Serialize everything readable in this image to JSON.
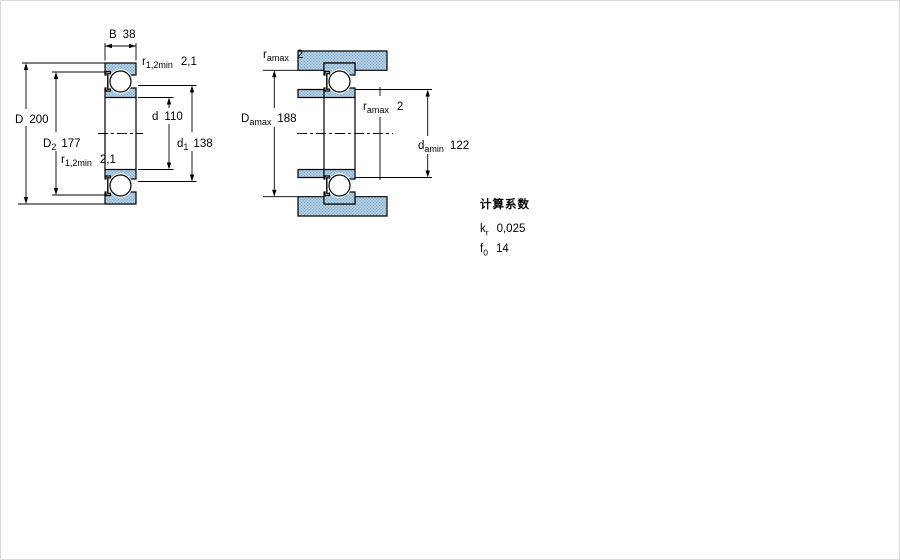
{
  "left_view": {
    "name": "bearing-cross-section",
    "dims": {
      "B": {
        "sym": "B",
        "val": "38"
      },
      "r_top": {
        "sym": "r",
        "sub": "1,2min",
        "val": "2,1"
      },
      "d": {
        "sym": "d",
        "val": "110"
      },
      "D": {
        "sym": "D",
        "val": "200"
      },
      "D2": {
        "sym": "D",
        "sub": "2",
        "val": "177"
      },
      "d1": {
        "sym": "d",
        "sub": "1",
        "val": "138"
      },
      "r_bottom": {
        "sym": "r",
        "sub": "1,2min",
        "val": "2,1"
      }
    }
  },
  "right_view": {
    "name": "abutment-dimensions",
    "dims": {
      "ra_top": {
        "sym": "r",
        "sub": "amax",
        "val": "2"
      },
      "Da": {
        "sym": "D",
        "sub": "amax",
        "val": "188"
      },
      "ra_mid": {
        "sym": "r",
        "sub": "amax",
        "val": "2"
      },
      "da": {
        "sym": "d",
        "sub": "amin",
        "val": "122"
      }
    }
  },
  "calculation_factors": {
    "title": "计算系数",
    "rows": [
      {
        "sym": "k",
        "sub": "r",
        "val": "0,025"
      },
      {
        "sym": "f",
        "sub": "0",
        "val": "14"
      }
    ]
  },
  "colors": {
    "section_fill": "#b7d2e6",
    "section_dot": "#7fa8cb",
    "line": "#000000",
    "background": "#ffffff"
  }
}
